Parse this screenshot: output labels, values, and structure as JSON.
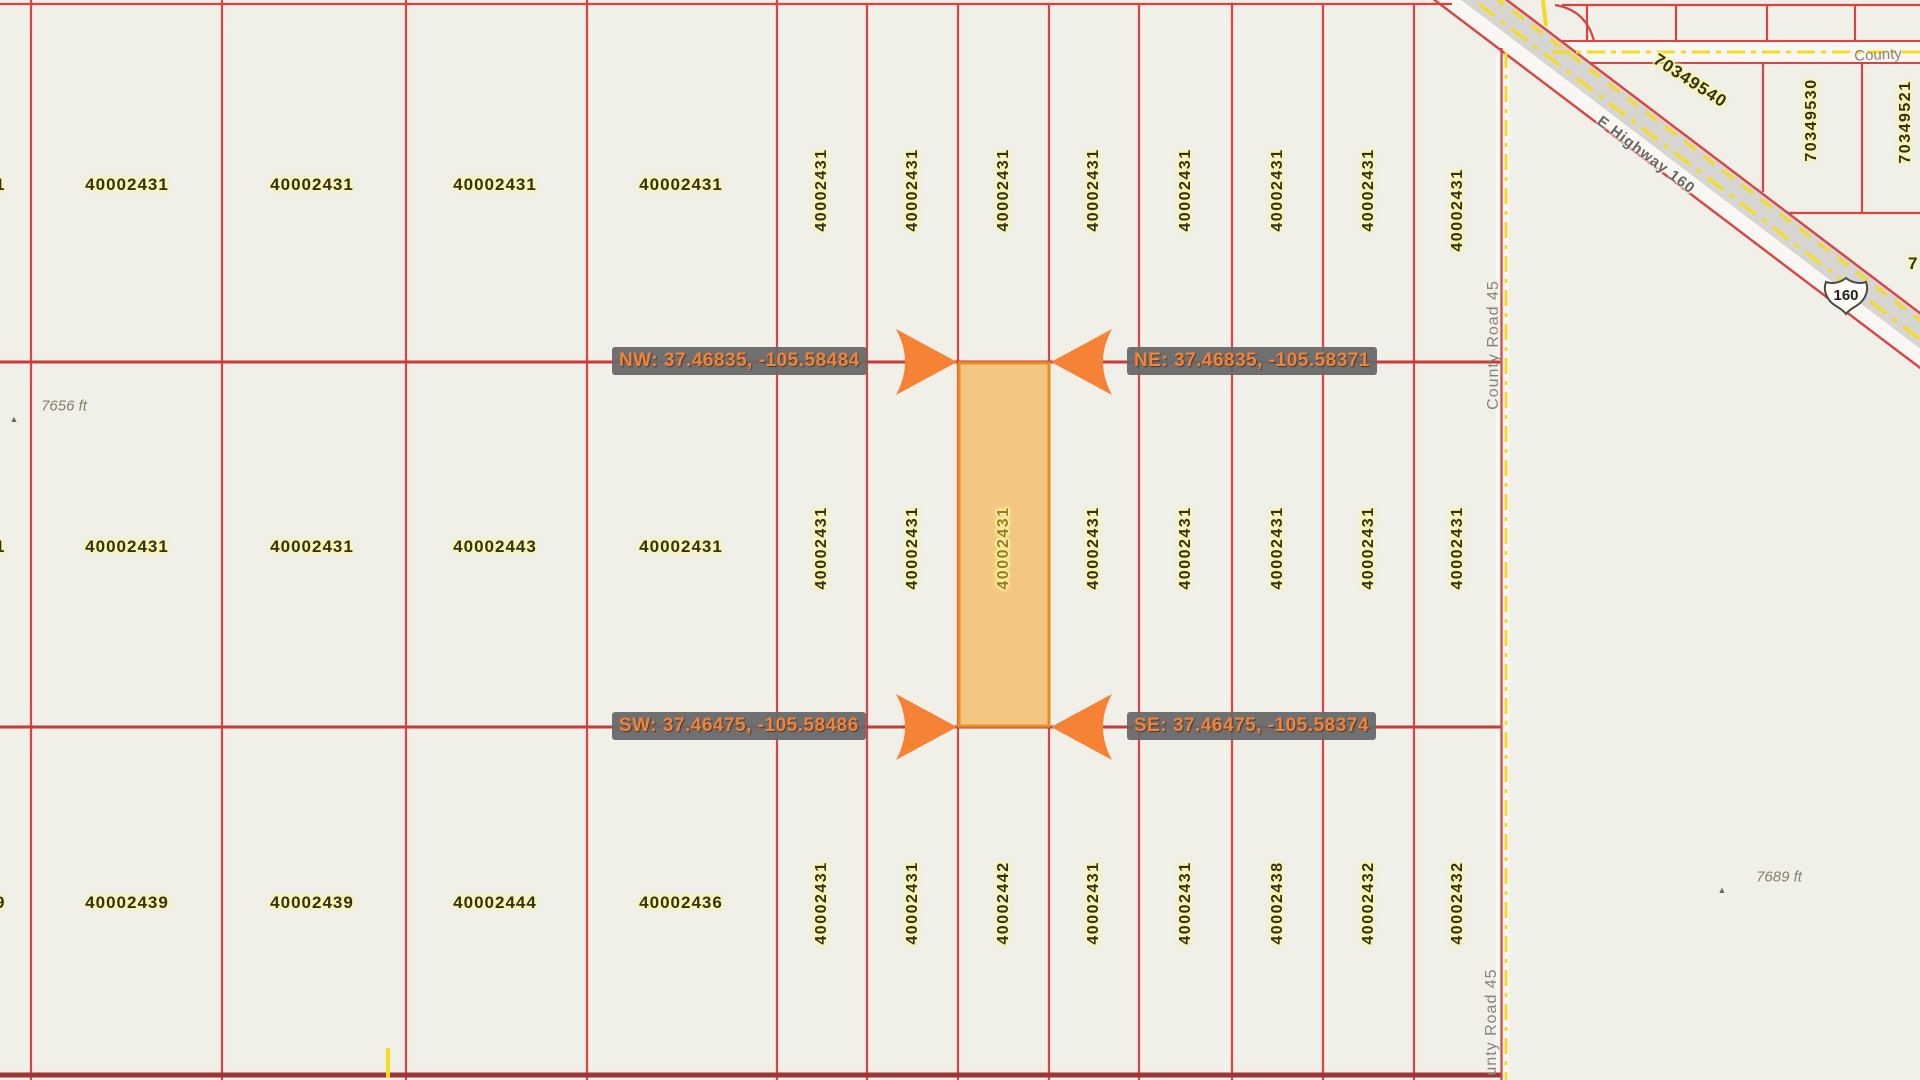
{
  "map": {
    "background": "#f0efe8",
    "parcel_line_color": "#d94343",
    "highlight_fill": "#f6af42",
    "highlight_border": "#ea8c22",
    "callout_bg": "#686868",
    "callout_text_color": "#f58235",
    "road_yellow": "#f3dc23"
  },
  "parcels": {
    "row1_wide": [
      "40002431",
      "40002431",
      "40002431",
      "40002431"
    ],
    "row1_narrow": [
      "40002431",
      "40002431",
      "40002431",
      "40002431",
      "40002431",
      "40002431",
      "40002431",
      "40002431"
    ],
    "row2_wide": [
      "40002431",
      "40002431",
      "40002443",
      "40002431"
    ],
    "row2_narrow": [
      "40002431",
      "40002431",
      "40002431",
      "40002431",
      "40002431",
      "40002431",
      "40002431",
      "40002431"
    ],
    "row3_wide": [
      "40002439",
      "40002439",
      "40002444",
      "40002436"
    ],
    "row3_narrow": [
      "40002431",
      "40002431",
      "40002442",
      "40002431",
      "40002431",
      "40002438",
      "40002432",
      "40002432"
    ],
    "left_edge_clipped": [
      "1",
      "1",
      "9"
    ],
    "upper_right": [
      "70349540",
      "70349530",
      "70349521"
    ],
    "right_edge_clipped": "7"
  },
  "callouts": {
    "nw": "NW: 37.46835, -105.58484",
    "ne": "NE: 37.46835, -105.58371",
    "sw": "SW: 37.46475, -105.58486",
    "se": "SE: 37.46475, -105.58374"
  },
  "roads": {
    "highway_name": "E Highway 160",
    "highway_shield": "160",
    "county_road": "County Road 45",
    "county_road_partial": "unty Road 45",
    "county_partial": "County"
  },
  "elevation_markers": [
    {
      "label": "7656 ft"
    },
    {
      "label": "7689 ft"
    }
  ]
}
